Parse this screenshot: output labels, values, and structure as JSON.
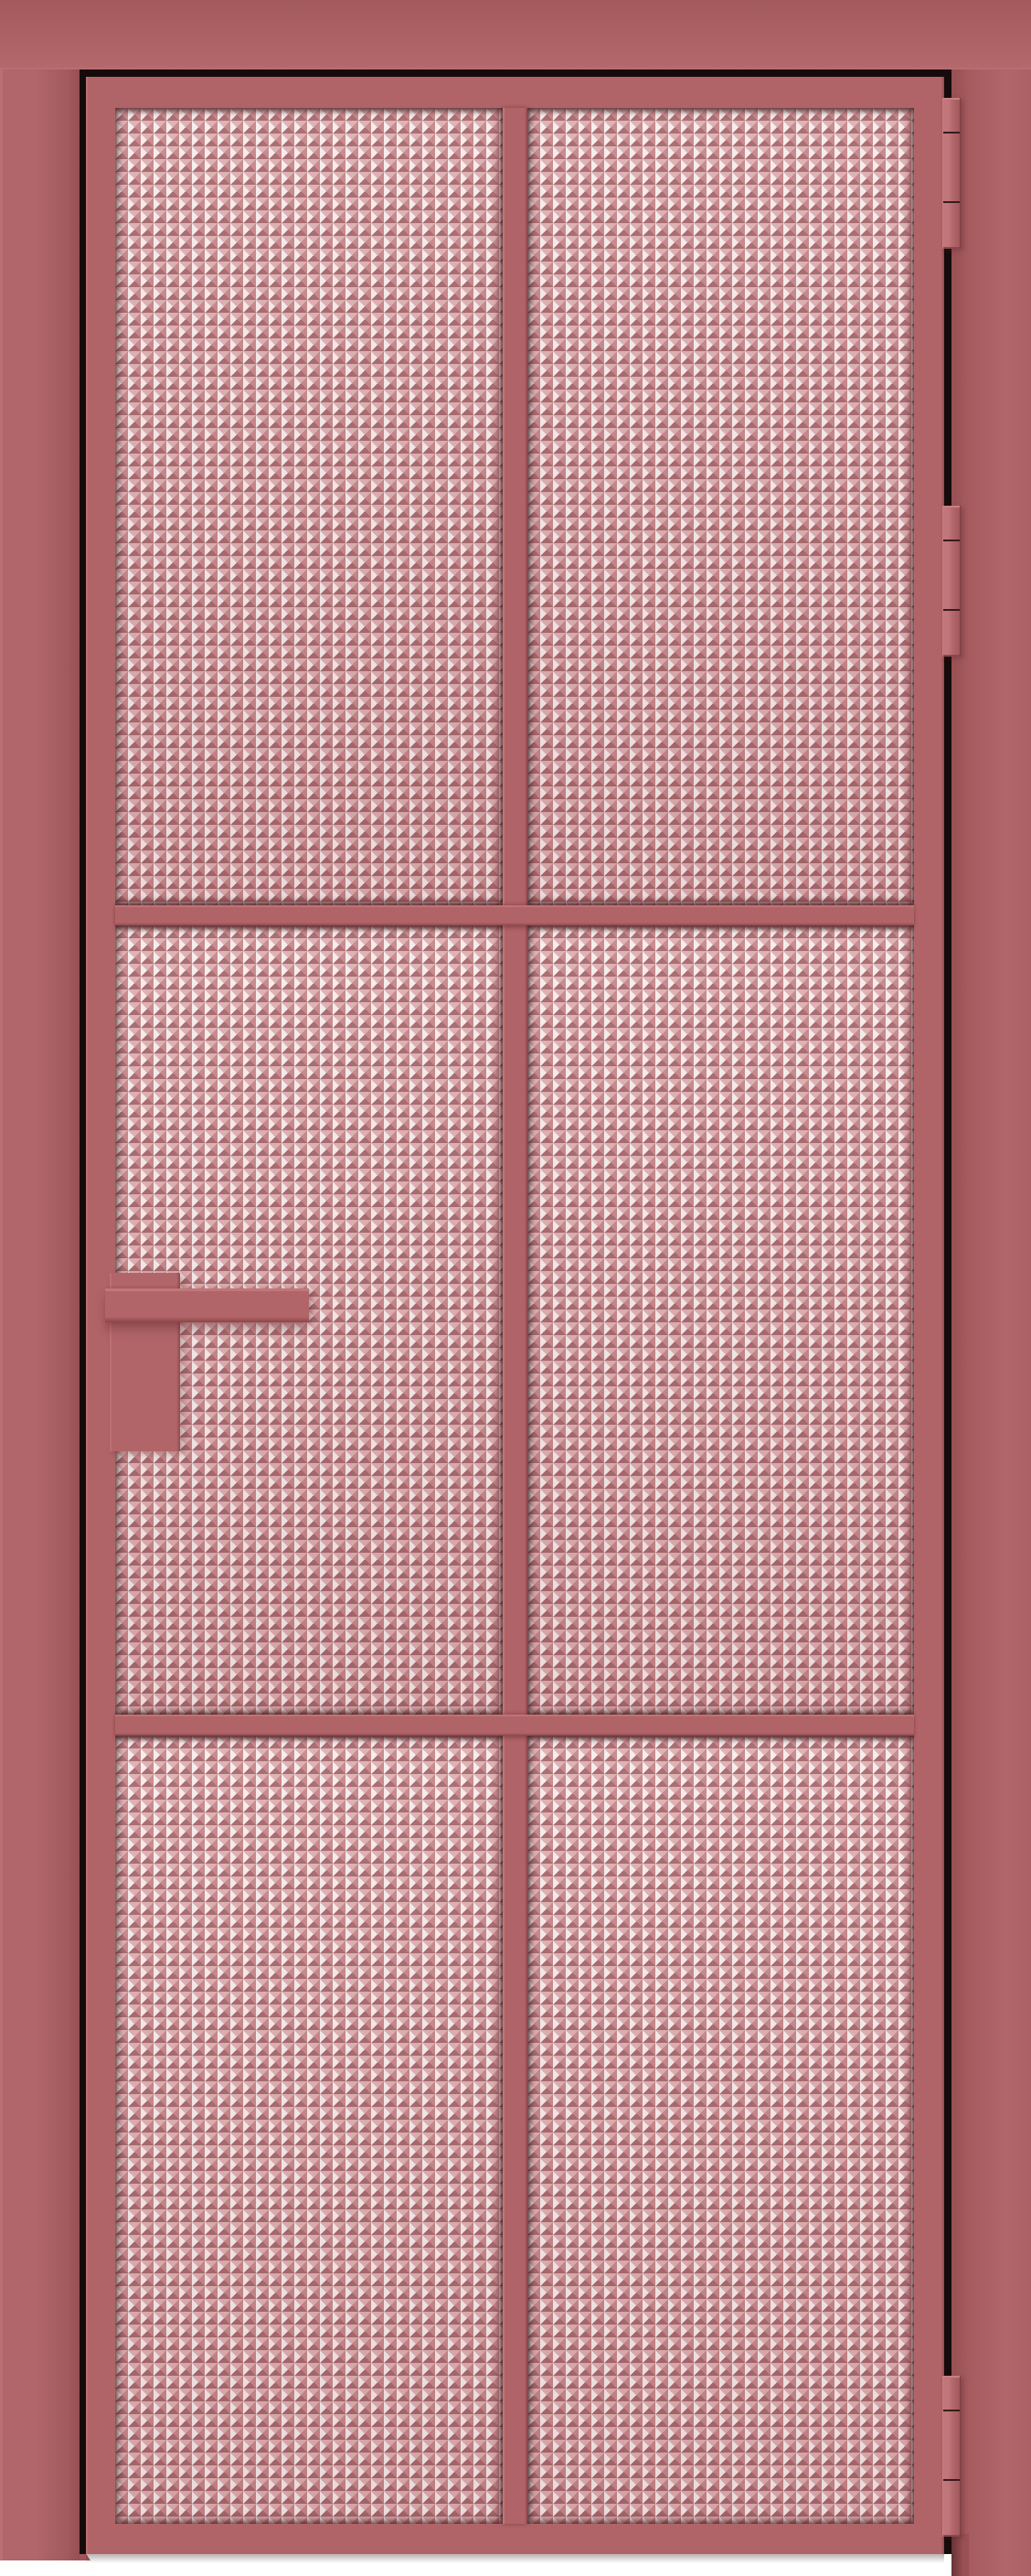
{
  "scene": {
    "title": "Interior aluminium glass door, antique-rose frame, front view",
    "subject": "single-leaf door with textured prismatic glazing on white studio background",
    "panel_grid": "2 columns x 3 rows",
    "panel_count": 6,
    "hinge_count": 3,
    "handle_side": "left",
    "hinge_side": "right"
  },
  "parts": {
    "casing_left": "left frame jamb",
    "casing_top": "top frame head",
    "casing_right": "right frame jamb (hinge side)",
    "rebate_gap": "dark rebate shadow between frame and leaf",
    "leaf": "door leaf with rose aluminium profile",
    "glass": "moru prism textured glass, pink tinted",
    "mullion": "full-height center vertical glazing bar",
    "muntin_upper": "upper horizontal glazing bar",
    "muntin_lower": "lower horizontal glazing bar",
    "handle_backplate": "rectangular handle backplate",
    "handle_lever": "square-profile lever handle pointing right",
    "hinges": "three barrel hinges on right edge"
  },
  "colors": {
    "background": "#ffffff",
    "frame": "#ab6164",
    "frame_light": "#bb7073",
    "frame_dark": "#974f52",
    "leaf": "#b16467",
    "edge_shadow": "#8c484c",
    "gap": "#170a0b",
    "glass_base": "#c9898d",
    "glass_highlight": "#f6ecec",
    "glass_light": "#ddafb2",
    "glass_mid": "#c68589",
    "glass_dark": "#a5676b",
    "hinge": "#b36669",
    "handle": "#b26568"
  }
}
